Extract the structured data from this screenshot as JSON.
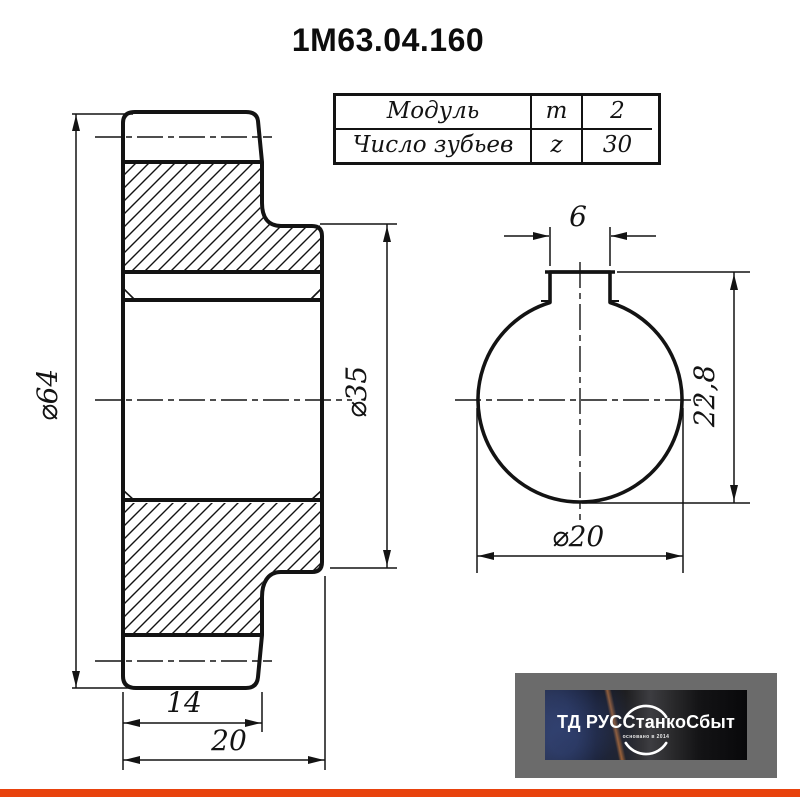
{
  "title": "1М63.04.160",
  "spec_table": {
    "rows": [
      {
        "label": "Модуль",
        "symbol": "m",
        "value": "2"
      },
      {
        "label": "Число зубьев",
        "symbol": "z",
        "value": "30"
      }
    ]
  },
  "drawing": {
    "section_view": {
      "outer_diameter_label": "⌀64",
      "hub_diameter_label": "⌀35",
      "rim_width_label": "14",
      "overall_width_label": "20"
    },
    "end_view": {
      "keyway_width_label": "6",
      "keyway_height_label": "22,8",
      "bore_diameter_label": "⌀20"
    }
  },
  "logo": {
    "company": "ТД РУССтанкоСбыт",
    "tagline": "основано в 2014"
  },
  "colors": {
    "ink": "#131313",
    "paper": "#ffffff",
    "accent_bar": "#e8420d",
    "logo_background": "#6b6b6b"
  }
}
